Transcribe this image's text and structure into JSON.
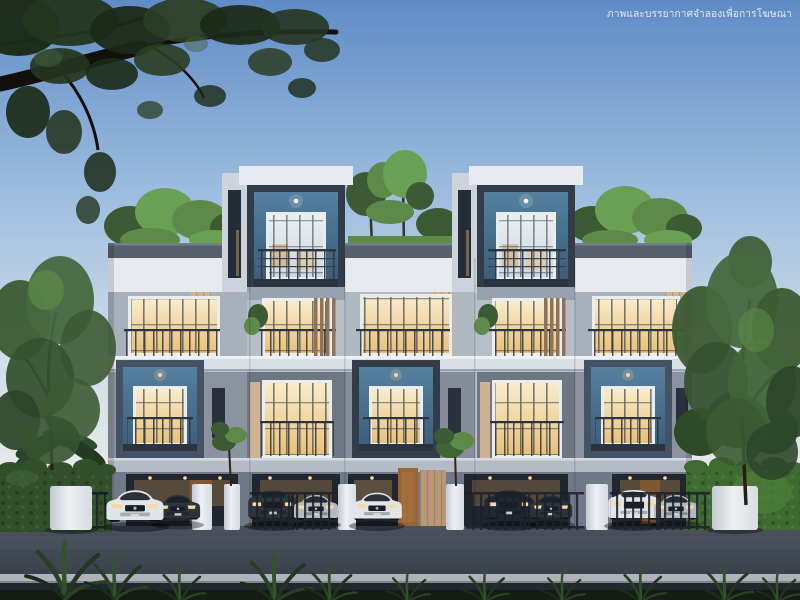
{
  "watermark": {
    "text": "ภาพและบรรยากาศจำลองเพื่อการโฆษณา"
  },
  "scene": {
    "type": "architectural-rendering",
    "time_of_day": "dusk",
    "subject": "Modern three-storey townhome row with rooftop gardens, navy box balconies, warm-lit windows, ground-floor carports, gate piers, hedges and parked cars on a front road",
    "balcony_boxes": 5,
    "cars": [
      {
        "type": "sedan",
        "color": "white"
      },
      {
        "type": "sedan",
        "color": "dark-grey"
      },
      {
        "type": "suv",
        "color": "dark-grey"
      },
      {
        "type": "sedan",
        "color": "silver"
      },
      {
        "type": "sedan",
        "color": "white"
      },
      {
        "type": "suv",
        "color": "dark-grey"
      },
      {
        "type": "sedan",
        "color": "dark-grey"
      },
      {
        "type": "suv",
        "color": "white"
      },
      {
        "type": "sedan",
        "color": "silver"
      }
    ]
  },
  "palette": {
    "sky_top": "#5f8cc6",
    "sky_mid": "#9dbcde",
    "sky_low": "#cfdce8",
    "sky_horizon": "#e7e9e8",
    "facade_white": "#e7eaef",
    "facade_light": "#cdd3db",
    "facade_gray": "#a8b0bb",
    "facade_mid": "#8b93a0",
    "facade_dark": "#6e7783",
    "parapet": "#575f6a",
    "slab": "#d9dee4",
    "box_frame": "#333d49",
    "box_frame2": "#445363",
    "window_frame": "#e9edf0",
    "mullion": "#39424e",
    "glow_warm": "#f3ddad",
    "glow_deep": "#e2ab5e",
    "wood_light": "#cfb292",
    "wood_dark": "#8f7358",
    "foliage_dark": "#1e2b19",
    "foliage_mid": "#3c5a33",
    "foliage_light": "#5d8a48",
    "roofgarden": "#6aa054",
    "hedge": "#31502b",
    "hedge_light": "#4e7d3a",
    "trunk": "#17130e",
    "road": "#464d57",
    "road_dark": "#343a43",
    "curb": "#aeb3b9",
    "walk": "#23282e",
    "grass_dark": "#151c14",
    "car_white": "#e2e5e8",
    "car_dark": "#2e343b",
    "car_dark2": "#222731",
    "car_silver": "#b3bac1",
    "pier_light": "#eef0f3",
    "gate_metal": "#20252c",
    "light_warm": "#ffd9a0"
  }
}
